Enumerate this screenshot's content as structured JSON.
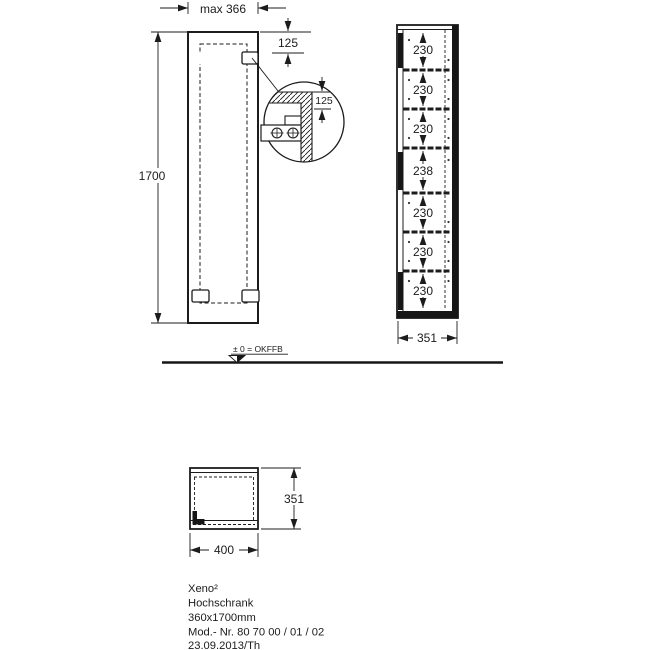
{
  "front_view": {
    "width_label": "max 366",
    "height_label": "1700",
    "top_offset_label": "125"
  },
  "detail_view": {
    "offset_label": "125"
  },
  "side_view": {
    "compartments": [
      "230",
      "230",
      "230",
      "238",
      "230",
      "230",
      "230"
    ],
    "depth_label": "351"
  },
  "floor": {
    "level_label": "± 0 = OKFFB"
  },
  "top_view": {
    "depth_label": "351",
    "width_label": "400"
  },
  "title_block": {
    "series": "Xeno²",
    "type": "Hochschrank",
    "size": "360x1700mm",
    "model_no": "Mod.- Nr. 80 70 00 / 01 / 02",
    "date_author": "23.09.2013/Th"
  }
}
